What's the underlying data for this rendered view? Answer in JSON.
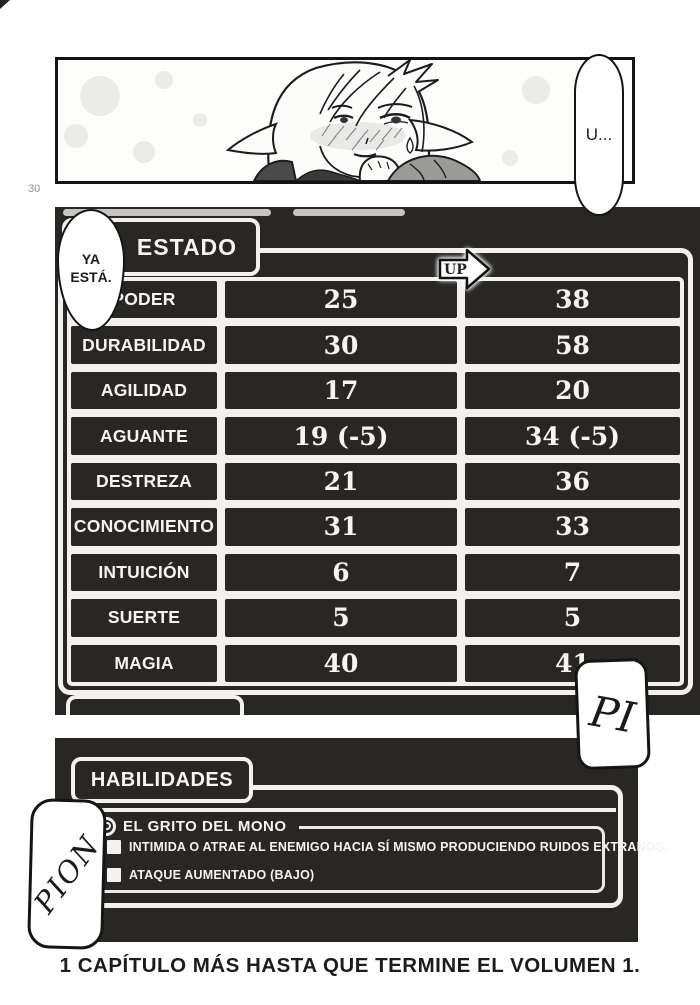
{
  "page": {
    "number": "30",
    "caption": "1 CAPÍTULO MÁS HASTA QUE TERMINE EL VOLUMEN 1."
  },
  "bubbles": {
    "u": "U...",
    "ya_esta": "YA ESTÁ.",
    "pi": "PI",
    "pion": "PION"
  },
  "estado": {
    "title": "ESTADO",
    "up_label": "UP",
    "rows": [
      {
        "label": "PODER",
        "before": "25",
        "after": "38"
      },
      {
        "label": "DURABILIDAD",
        "before": "30",
        "after": "58"
      },
      {
        "label": "AGILIDAD",
        "before": "17",
        "after": "20"
      },
      {
        "label": "AGUANTE",
        "before": "19 (-5)",
        "after": "34 (-5)"
      },
      {
        "label": "DESTREZA",
        "before": "21",
        "after": "36"
      },
      {
        "label": "CONOCIMIENTO",
        "before": "31",
        "after": "33"
      },
      {
        "label": "INTUICIÓN",
        "before": "6",
        "after": "7"
      },
      {
        "label": "SUERTE",
        "before": "5",
        "after": "5"
      },
      {
        "label": "MAGIA",
        "before": "40",
        "after": "41"
      }
    ]
  },
  "habilidades": {
    "title": "HABILIDADES",
    "skill_name": "EL GRITO DEL MONO",
    "effects": [
      {
        "text": "INTIMIDA O ATRAE AL ENEMIGO HACIA SÍ MISMO PRODUCIENDO RUIDOS EXTRAÑOS."
      },
      {
        "text": "ATAQUE AUMENTADO (BAJO)"
      }
    ]
  },
  "colors": {
    "section_bg": "#292724",
    "border_white": "#f2f1ed",
    "page_bg": "#ffffff",
    "ink": "#141414"
  }
}
